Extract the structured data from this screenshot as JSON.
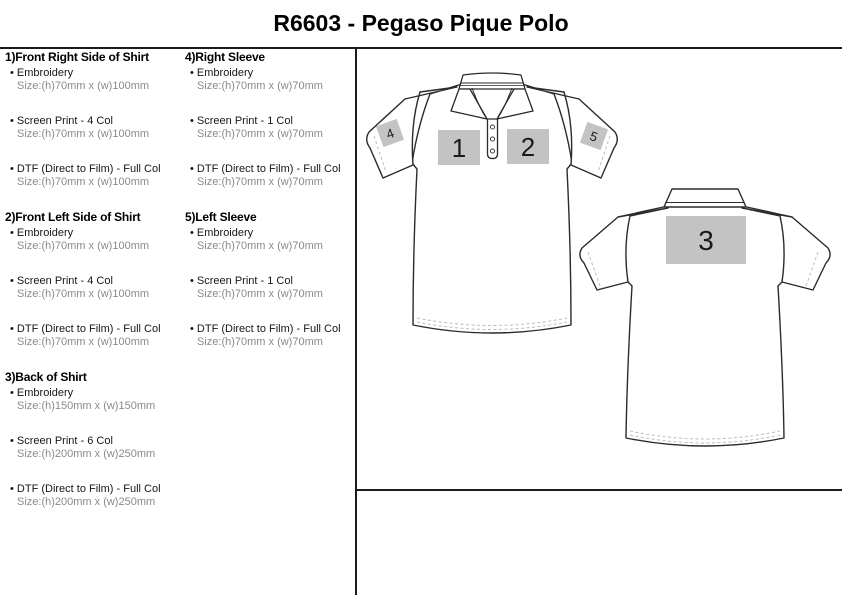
{
  "title": "R6603 - Pegaso Pique Polo",
  "bullet": "•",
  "sections": [
    {
      "column": 1,
      "heading": "1)Front Right Side of Shirt",
      "items": [
        {
          "label": "Embroidery",
          "size": "Size:(h)70mm x (w)100mm"
        },
        {
          "label": "Screen Print - 4 Col",
          "size": "Size:(h)70mm x (w)100mm"
        },
        {
          "label": "DTF (Direct to Film) - Full Col",
          "size": "Size:(h)70mm x (w)100mm"
        }
      ]
    },
    {
      "column": 1,
      "heading": "2)Front Left Side of Shirt",
      "items": [
        {
          "label": "Embroidery",
          "size": "Size:(h)70mm x (w)100mm"
        },
        {
          "label": "Screen Print - 4 Col",
          "size": "Size:(h)70mm x (w)100mm"
        },
        {
          "label": "DTF (Direct to Film) - Full Col",
          "size": "Size:(h)70mm x (w)100mm"
        }
      ]
    },
    {
      "column": 1,
      "heading": "3)Back of Shirt",
      "items": [
        {
          "label": "Embroidery",
          "size": "Size:(h)150mm x (w)150mm"
        },
        {
          "label": "Screen Print - 6 Col",
          "size": "Size:(h)200mm x (w)250mm"
        },
        {
          "label": "DTF (Direct to Film) - Full Col",
          "size": "Size:(h)200mm x (w)250mm"
        }
      ]
    },
    {
      "column": 2,
      "heading": "4)Right Sleeve",
      "items": [
        {
          "label": "Embroidery",
          "size": "Size:(h)70mm x (w)70mm"
        },
        {
          "label": "Screen Print - 1 Col",
          "size": "Size:(h)70mm x (w)70mm"
        },
        {
          "label": "DTF (Direct to Film) - Full Col",
          "size": "Size:(h)70mm x (w)70mm"
        }
      ]
    },
    {
      "column": 2,
      "heading": "5)Left Sleeve",
      "items": [
        {
          "label": "Embroidery",
          "size": "Size:(h)70mm x (w)70mm"
        },
        {
          "label": "Screen Print - 1 Col",
          "size": "Size:(h)70mm x (w)70mm"
        },
        {
          "label": "DTF (Direct to Film) - Full Col",
          "size": "Size:(h)70mm x (w)70mm"
        }
      ]
    }
  ],
  "diagram": {
    "marker_fill": "#c3c3c3",
    "outline_color": "#2b2b2b",
    "stitch_color": "#bcbcbc",
    "markers": {
      "pos1": "1",
      "pos2": "2",
      "pos3": "3",
      "pos4": "4",
      "pos5": "5"
    }
  }
}
